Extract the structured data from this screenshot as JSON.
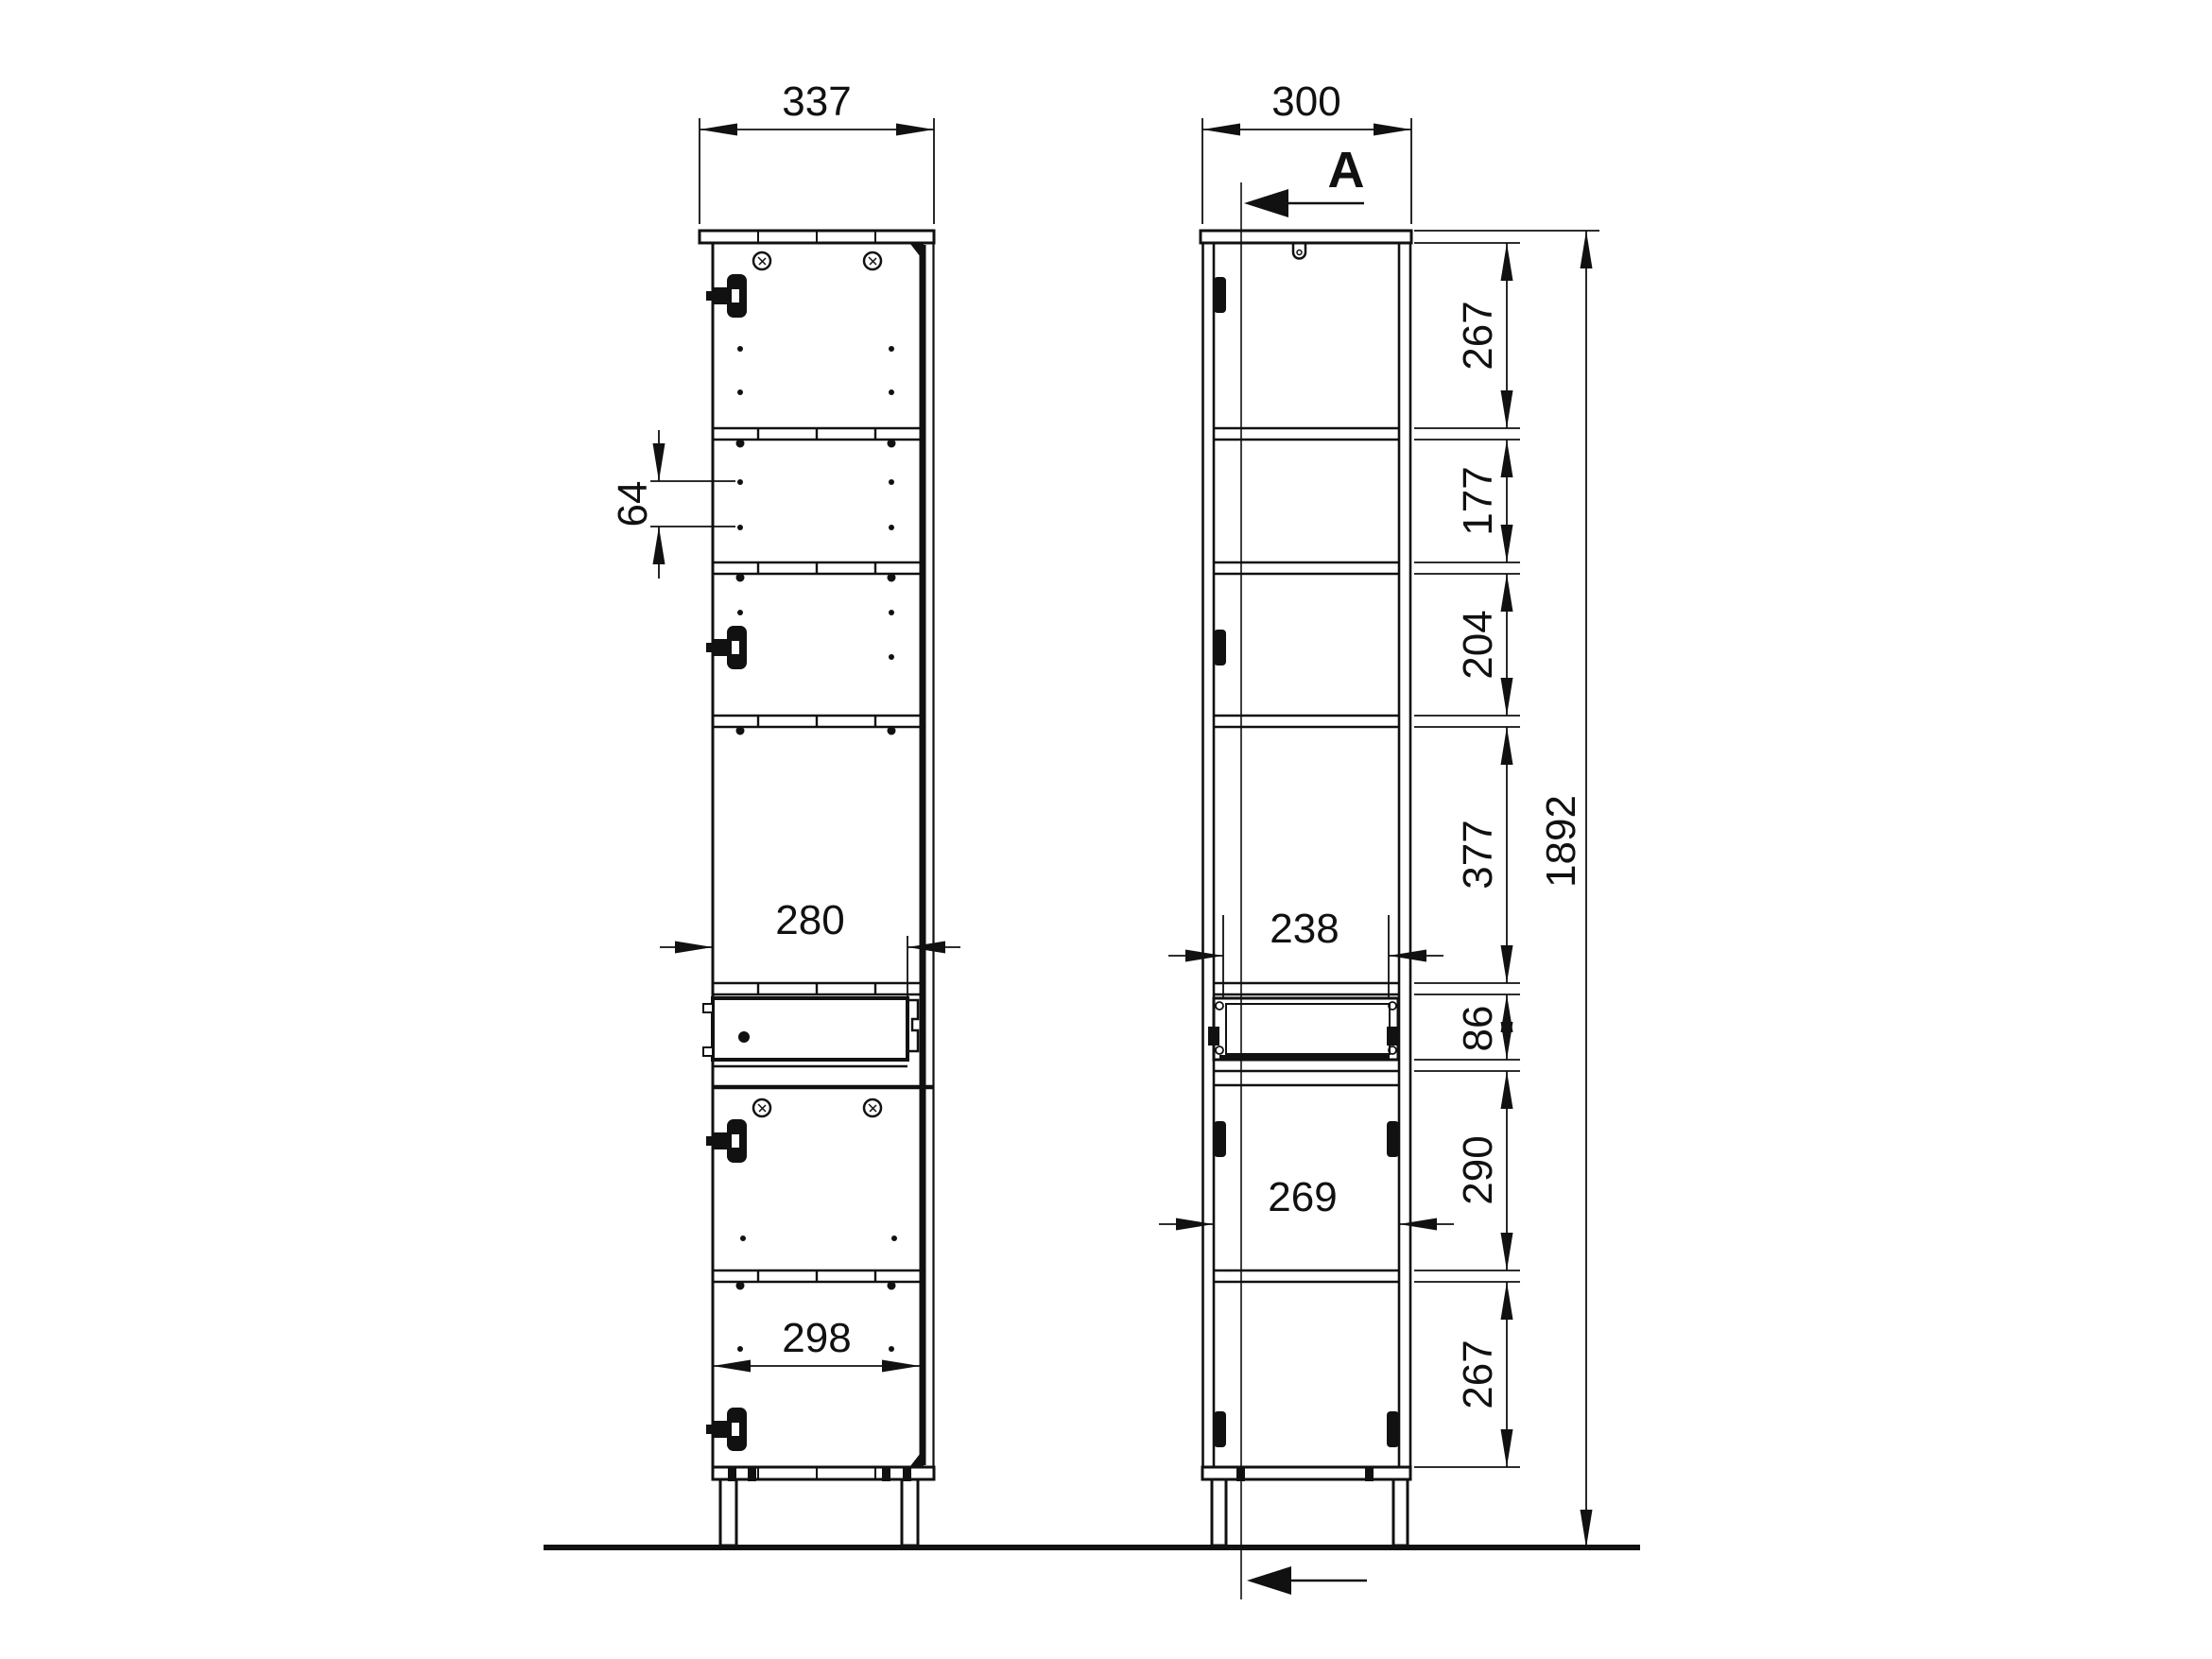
{
  "drawing_title": "Tall cabinet technical drawing, front view and section A",
  "front_view": {
    "top_width": "337",
    "hole_spacing": "64",
    "drawer_front_width": "280",
    "door_width": "298"
  },
  "side_view": {
    "top_depth": "300",
    "section_label": "A",
    "drawer_inner_depth": "238",
    "lower_compartment_depth": "269"
  },
  "height_chain": {
    "seg_1": "267",
    "seg_2": "177",
    "seg_3": "204",
    "seg_4": "377",
    "seg_5": "86",
    "seg_6": "290",
    "seg_7": "267"
  },
  "overall": {
    "height": "1892"
  }
}
